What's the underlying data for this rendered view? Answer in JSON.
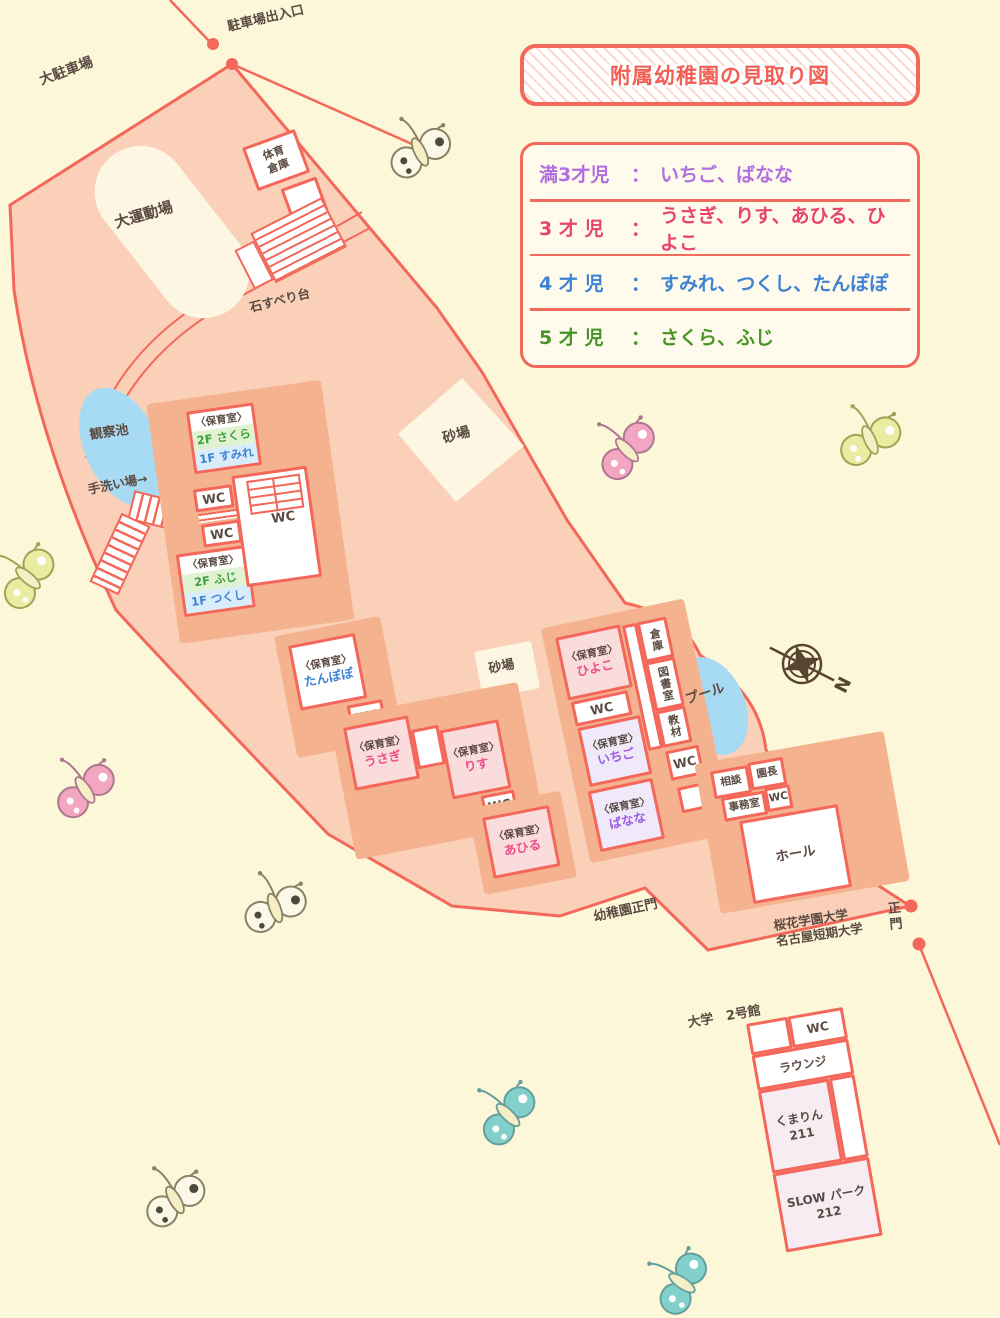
{
  "title": "附属幼稚園の見取り図",
  "legend": {
    "colon": "：",
    "rows": [
      {
        "label": "満3才児",
        "names": "いちご、ばなな",
        "color": "#b06ee0"
      },
      {
        "label": "3 才 児",
        "names": "うさぎ、りす、あひる、ひよこ",
        "color": "#e8436f"
      },
      {
        "label": "4 才 児",
        "names": "すみれ、つくし、たんぽぽ",
        "color": "#3d82d4"
      },
      {
        "label": "5 才 児",
        "names": "さくら、ふじ",
        "color": "#4a9427"
      }
    ]
  },
  "labels": {
    "parking_gate": "駐車場出入口",
    "parking": "大駐車場",
    "field": "大運動場",
    "gym_storage": "体育倉庫",
    "slide": "石すべり台",
    "pond": "観察池",
    "handwash": "手洗い場→",
    "sandbox": "砂場",
    "pool": "プール",
    "hall": "ホール",
    "kinder_gate": "幼稚園正門",
    "univ_line1": "桜花学園大学",
    "univ_line2": "名古屋短期大学",
    "main_gate": "正門",
    "bldg": "大学　2号館",
    "north": "N"
  },
  "rooms": {
    "header": "〈保育室〉",
    "wc": "WC",
    "sakura": "2F さくら",
    "sumire": "1F すみれ",
    "fuji": "2F ふじ",
    "tsukushi": "1F つくし",
    "tanpopo": "たんぽぽ",
    "usagi": "うさぎ",
    "risu": "りす",
    "ahiru": "あひる",
    "hiyoko": "ひよこ",
    "ichigo": "いちご",
    "banana": "ばなな"
  },
  "storage": {
    "c1": "倉庫",
    "c2": "図書室",
    "c3": "教材"
  },
  "office": {
    "sodan": "相談",
    "encho": "園長",
    "jimu": "事務室",
    "wc": "WC"
  },
  "university": {
    "wc": "WC",
    "lounge": "ラウンジ",
    "room1a": "くまりん",
    "room1b": "211",
    "room2a": "SLOW パーク",
    "room2b": "212"
  }
}
